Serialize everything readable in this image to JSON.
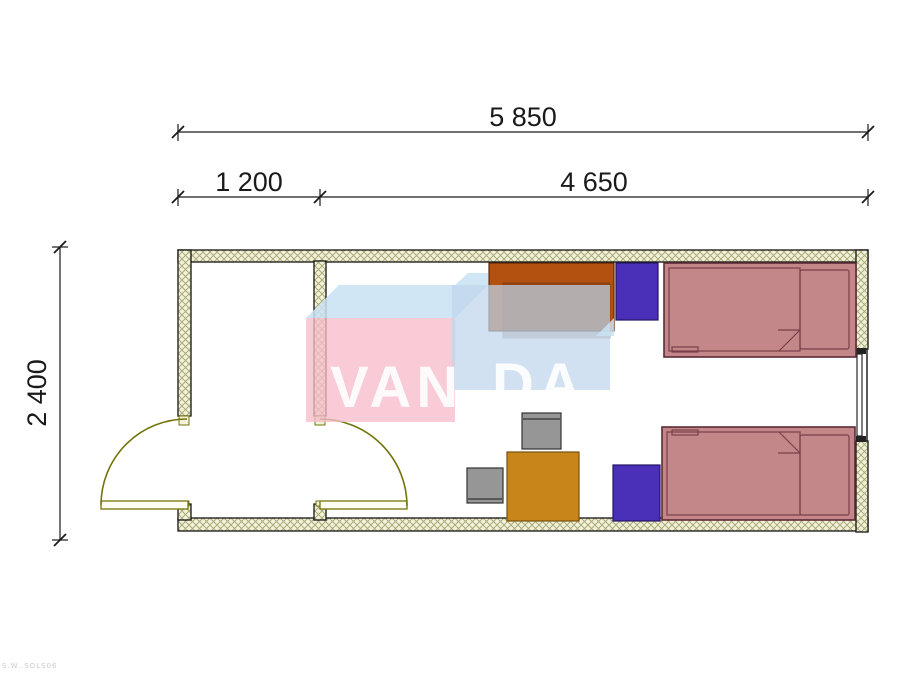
{
  "dimensions": {
    "overall_width": "5 850",
    "entry_width": "1 200",
    "main_room_width": "4 650",
    "depth": "2 400"
  },
  "watermark": {
    "text_left": "VAN",
    "text_right": "DA"
  },
  "corner_note": "S.W..SOLS06",
  "palette": {
    "wall_fill": "#F2F2DC",
    "wall_hatch": "#ABAB77",
    "outline": "#141414",
    "door_olive": "#74740C",
    "bed_pink": "#C38689",
    "bed_border": "#5C2B35",
    "nightstand_blue": "#4A30B8",
    "table_gold": "#C8861A",
    "chair_gray": "#969696",
    "wardrobe_orange": "#B35110",
    "watermark_pink": "#F6BCCB",
    "watermark_blue": "#BFD5EC",
    "watermark_sky": "#C9E2F3"
  },
  "plan": {
    "rooms": [
      {
        "name": "entry-vestibule"
      },
      {
        "name": "main-room"
      }
    ],
    "openings": [
      {
        "name": "entrance-door",
        "wall": "left"
      },
      {
        "name": "interior-door",
        "wall": "partition"
      },
      {
        "name": "window",
        "wall": "right"
      }
    ],
    "furniture": [
      {
        "name": "wardrobe"
      },
      {
        "name": "nightstand-top"
      },
      {
        "name": "bed-top"
      },
      {
        "name": "table"
      },
      {
        "name": "chair-top"
      },
      {
        "name": "chair-left"
      },
      {
        "name": "nightstand-bottom"
      },
      {
        "name": "bed-bottom"
      }
    ]
  }
}
